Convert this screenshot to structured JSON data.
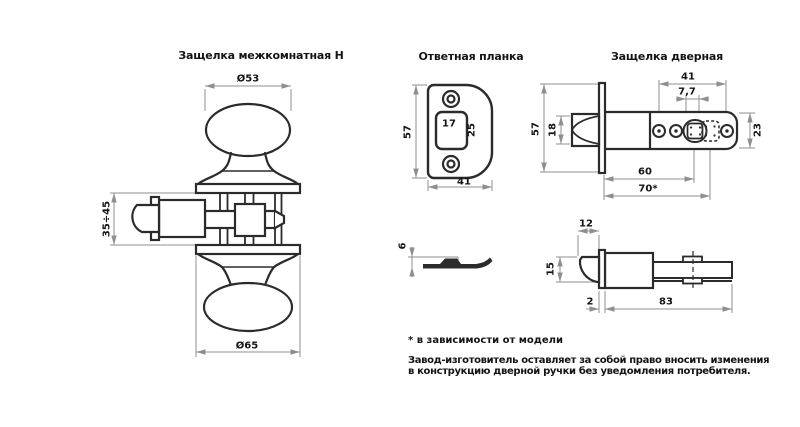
{
  "left": {
    "title": "Защелка межкомнатная Н",
    "dims": {
      "knob_top": "Ø53",
      "door": "35÷45",
      "knob_bottom": "Ø65"
    }
  },
  "middle": {
    "title": "Ответная планка",
    "dims": {
      "height": "57",
      "hole_width": "17",
      "hole_height": "25",
      "width": "41",
      "thickness": "6"
    }
  },
  "right": {
    "title": "Защелка дверная",
    "dims": {
      "face_height": "57",
      "bolt_height": "18",
      "holes_span": "41",
      "square": "7,7",
      "tube_height": "23",
      "backset_1": "60",
      "backset_2": "70*",
      "bolt_length": "12",
      "bolt_width": "15",
      "face_thickness": "2",
      "body_length": "83"
    }
  },
  "footnote": {
    "model_note": "* в зависимости от модели",
    "disclaimer_line1": "Завод-изготовитель оставляет за собой право вносить изменения",
    "disclaimer_line2": "в конструкцию дверной ручки без уведомления потребителя."
  },
  "colors": {
    "line": "#2b2b2b",
    "dimension": "#8f8f8f",
    "background": "#ffffff"
  }
}
